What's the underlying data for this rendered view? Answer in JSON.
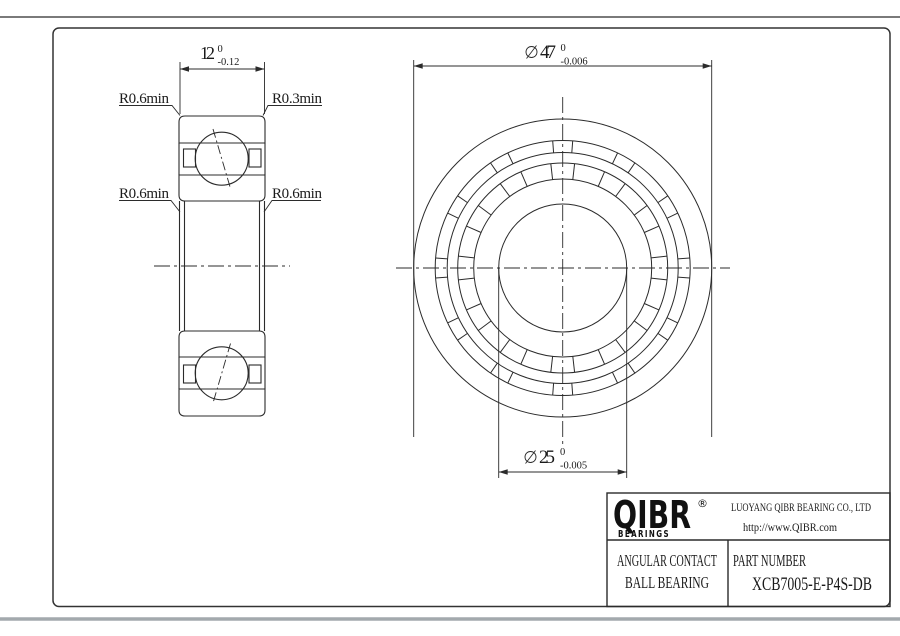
{
  "drawing": {
    "section_view": {
      "width_dim": {
        "nominal": "12",
        "upper_tol": "0",
        "lower_tol": "-0.12"
      },
      "fillet_labels": {
        "top_left": "R0.6min",
        "top_right": "R0.3min",
        "mid_left": "R0.6min",
        "mid_right": "R0.6min"
      }
    },
    "front_view": {
      "od_dim": {
        "symbol": "⌀",
        "nominal": "47",
        "upper_tol": "0",
        "lower_tol": "-0.006"
      },
      "bore_dim": {
        "symbol": "⌀",
        "nominal": "25",
        "upper_tol": "0",
        "lower_tol": "-0.005"
      }
    }
  },
  "title_block": {
    "brand": "QIBR",
    "registered": "®",
    "brand_sub": "BEARINGS",
    "company": "LUOYANG QIBR BEARING CO., LTD",
    "website": "http://www.QIBR.com",
    "product_type_line1": "ANGULAR CONTACT",
    "product_type_line2": "BALL BEARING",
    "part_number_label": "PART NUMBER",
    "part_number": "XCB7005-E-P4S-DB"
  },
  "colors": {
    "line": "#2b2b2b",
    "page_edge": "#4f4f4f",
    "page_shadow": "#a3a9ad",
    "background": "#ffffff"
  }
}
